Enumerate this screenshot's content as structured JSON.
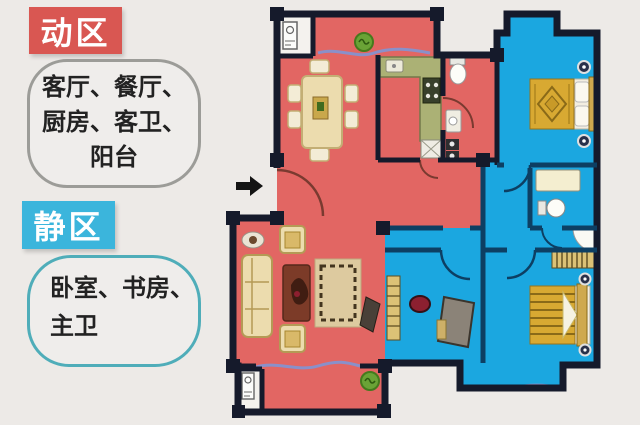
{
  "page": {
    "background_color": "#edeae7"
  },
  "legend": {
    "active": {
      "label": "动区",
      "label_color": "#d95752",
      "bubble_border_color": "#9c9c98",
      "rooms": "客厅、餐厅、厨房、客卫、阳台",
      "lines": [
        "客厅、餐厅、",
        "厨房、客卫、",
        "阳台"
      ]
    },
    "quiet": {
      "label": "静区",
      "label_color": "#3bb5dc",
      "bubble_border_color": "#4fadb9",
      "rooms": "卧室、书房、主卫",
      "lines": [
        "卧室、书房、",
        "主卫"
      ]
    }
  },
  "floorplan": {
    "active_zone_fill": "#e26663",
    "quiet_zone_fill": "#1ba7e0",
    "wall_color": "#151a2b",
    "quiet_wall_color": "#0d3f63",
    "window_color": "#8a90c9",
    "counter_color": "#abb175",
    "furniture_color": "#ecdcae",
    "bed_color": "#d8a932",
    "plant_color": "#6aa336",
    "furniture_icons": [
      "dining-table",
      "chair",
      "plant",
      "kitchen-counter",
      "sink",
      "stove",
      "fridge",
      "toilet",
      "vanity",
      "sofa",
      "side-table",
      "armchair",
      "coffee-table",
      "rug",
      "tv",
      "double-bed",
      "nightstand",
      "wardrobe",
      "shower",
      "desk",
      "desk-chair",
      "bookshelf",
      "washing-machine",
      "entry-arrow",
      "door-arc",
      "window-line"
    ]
  }
}
